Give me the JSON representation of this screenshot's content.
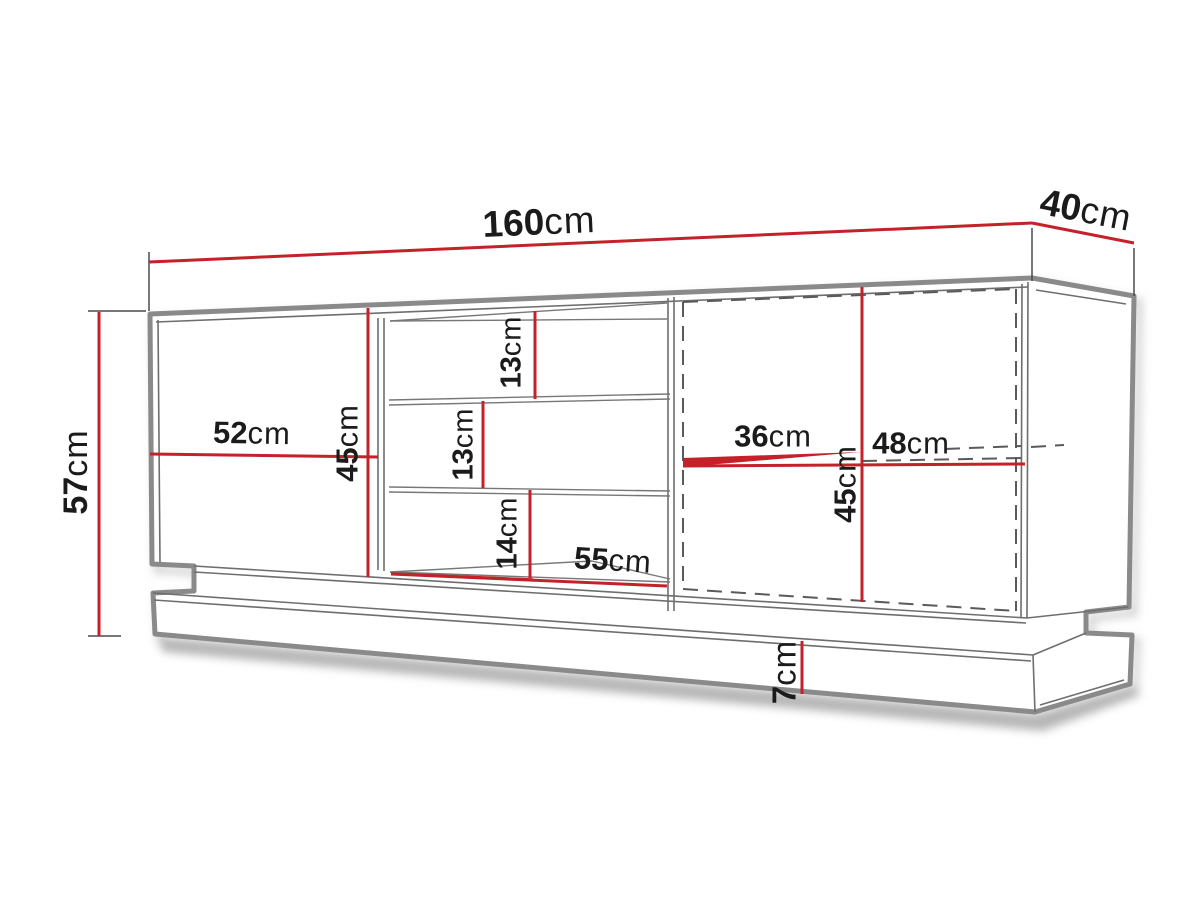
{
  "diagram": {
    "kind": "furniture-dimension-drawing",
    "unit": "cm"
  },
  "colors": {
    "dimension_line": "#c4222a",
    "outline": "#8a8a8a",
    "inner_line": "#6e6e6e",
    "text": "#1b1b1b",
    "background": "#ffffff"
  },
  "dims": {
    "w160": {
      "value": "160",
      "unit": "cm"
    },
    "d40": {
      "value": "40",
      "unit": "cm"
    },
    "h57": {
      "value": "57",
      "unit": "cm"
    },
    "w52": {
      "value": "52",
      "unit": "cm"
    },
    "h45_left": {
      "value": "45",
      "unit": "cm"
    },
    "h13_top": {
      "value": "13",
      "unit": "cm"
    },
    "h13_mid": {
      "value": "13",
      "unit": "cm"
    },
    "h14": {
      "value": "14",
      "unit": "cm"
    },
    "w55": {
      "value": "55",
      "unit": "cm"
    },
    "w36": {
      "value": "36",
      "unit": "cm"
    },
    "w48": {
      "value": "48",
      "unit": "cm"
    },
    "h45_right": {
      "value": "45",
      "unit": "cm"
    },
    "h7": {
      "value": "7",
      "unit": "cm"
    }
  }
}
